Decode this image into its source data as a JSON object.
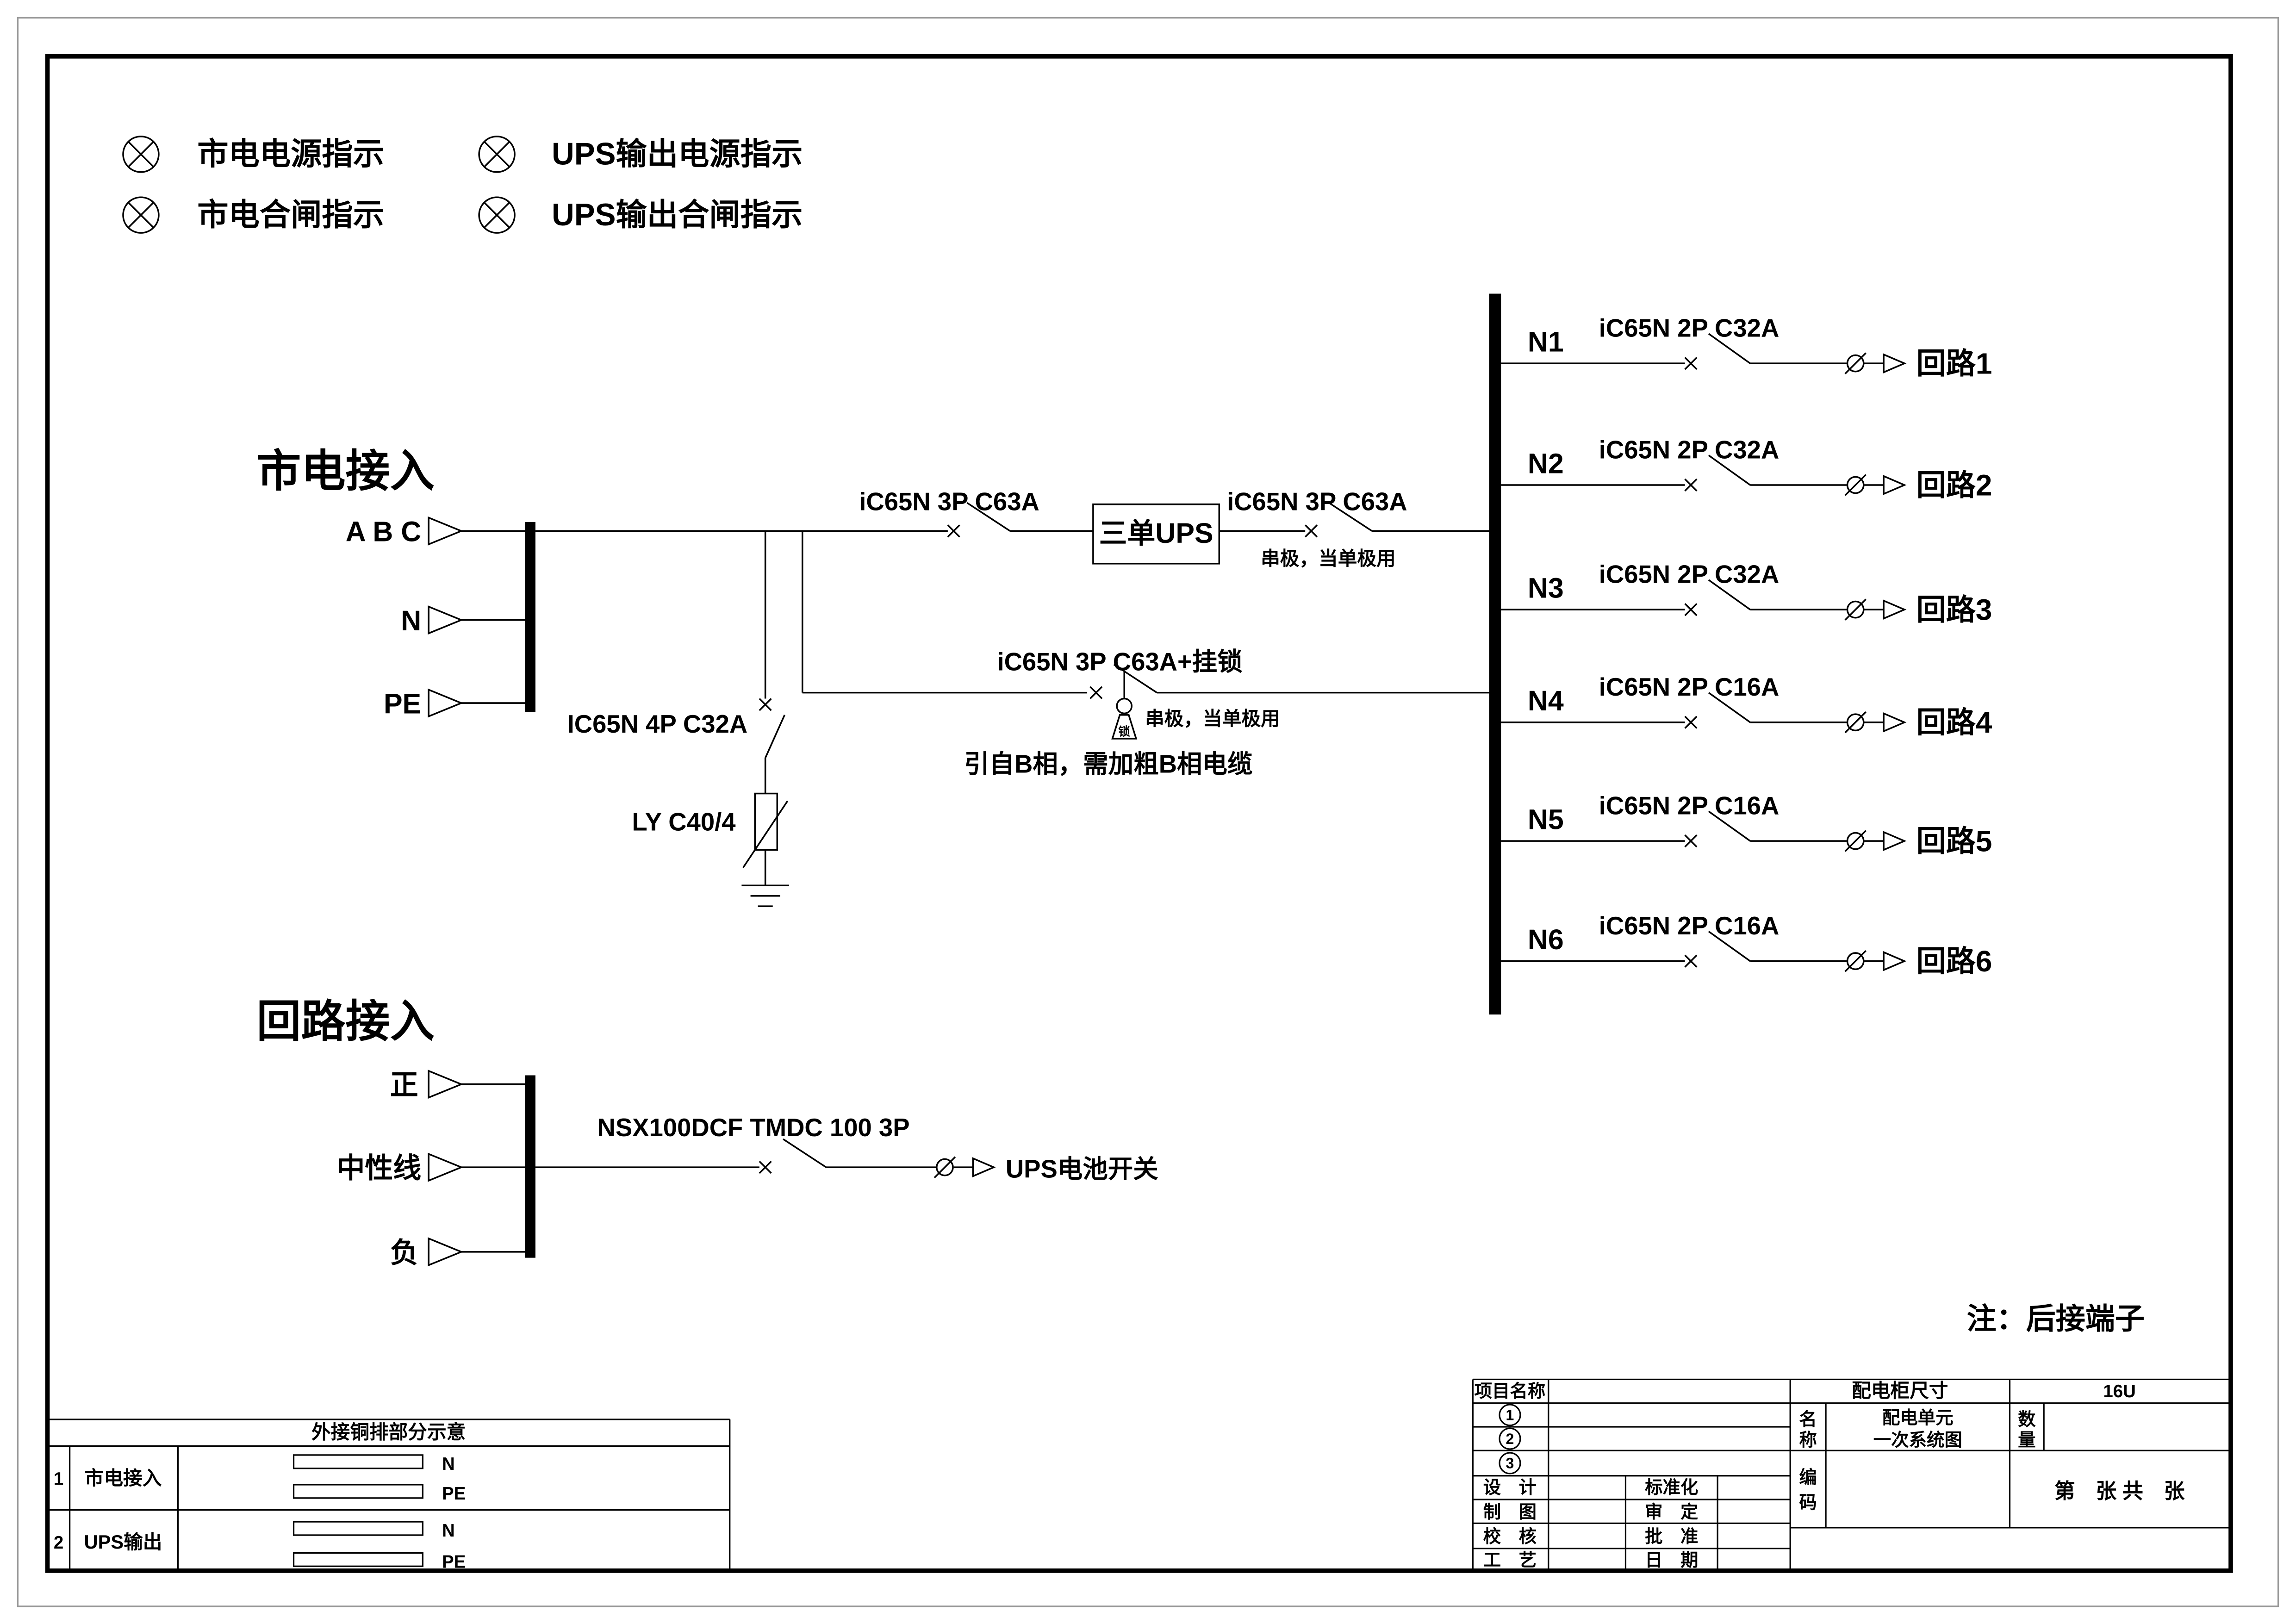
{
  "colors": {
    "ink": "#000000",
    "paper": "#ffffff"
  },
  "legend": {
    "items": [
      {
        "label": "市电电源指示"
      },
      {
        "label": "UPS输出电源指示"
      },
      {
        "label": "市电合闸指示"
      },
      {
        "label": "UPS输出合闸指示"
      }
    ]
  },
  "mains": {
    "title": "市电接入",
    "inputs": [
      {
        "label": "A B C"
      },
      {
        "label": "N"
      },
      {
        "label": "PE"
      }
    ],
    "incoming_breaker": "iC65N 3P C63A",
    "ups_box": "三单UPS",
    "outgoing_breaker": "iC65N 3P C63A",
    "outgoing_note": "串极，当单极用",
    "bypass_breaker": "iC65N 3P C63A+挂锁",
    "bypass_note": "串极，当单极用",
    "bypass_lock_char": "锁",
    "bypass_cable_note": "引自B相，需加粗B相电缆",
    "spd_breaker": "IC65N 4P C32A",
    "spd": "LY C40/4"
  },
  "outputs": {
    "circuits": [
      {
        "id": "N1",
        "breaker": "iC65N 2P C32A",
        "label": "回路1"
      },
      {
        "id": "N2",
        "breaker": "iC65N 2P C32A",
        "label": "回路2"
      },
      {
        "id": "N3",
        "breaker": "iC65N 2P C32A",
        "label": "回路3"
      },
      {
        "id": "N4",
        "breaker": "iC65N 2P C16A",
        "label": "回路4"
      },
      {
        "id": "N5",
        "breaker": "iC65N 2P C16A",
        "label": "回路5"
      },
      {
        "id": "N6",
        "breaker": "iC65N 2P C16A",
        "label": "回路6"
      }
    ]
  },
  "battery": {
    "title": "回路接入",
    "inputs": [
      {
        "label": "正"
      },
      {
        "label": "中性线"
      },
      {
        "label": "负"
      }
    ],
    "breaker": "NSX100DCF TMDC 100 3P",
    "output_label": "UPS电池开关"
  },
  "note": "注：后接端子",
  "busbar_table": {
    "title": "外接铜排部分示意",
    "rows": [
      {
        "no": "1",
        "name": "市电接入",
        "bars": [
          {
            "label": "N"
          },
          {
            "label": "PE"
          }
        ]
      },
      {
        "no": "2",
        "name": "UPS输出",
        "bars": [
          {
            "label": "N"
          },
          {
            "label": "PE"
          }
        ]
      }
    ]
  },
  "title_block": {
    "project_label": "项目名称",
    "circled": [
      "1",
      "2",
      "3"
    ],
    "cabinet_size_label": "配电柜尺寸",
    "cabinet_size": "16U",
    "name_chars": [
      "名",
      "称"
    ],
    "name_line1": "配电单元",
    "name_line2": "一次系统图",
    "qty_chars": [
      "数",
      "量"
    ],
    "code_chars": [
      "编",
      "码"
    ],
    "sheet_text": "第　张 共　张",
    "design": "设　计",
    "draft": "制　图",
    "check": "校　核",
    "process": "工　艺",
    "standard": "标准化",
    "review": "审　定",
    "approve": "批　准",
    "date": "日　期"
  }
}
